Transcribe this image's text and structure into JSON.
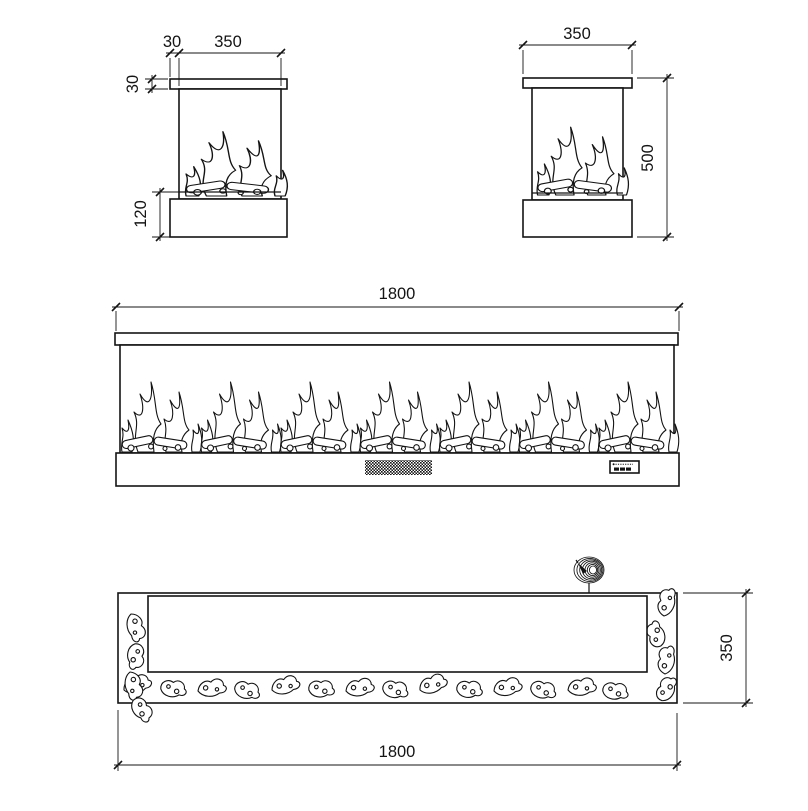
{
  "colors": {
    "line": "#141414",
    "background": "#ffffff"
  },
  "views": {
    "side_detail": {
      "dims": {
        "cap_overhang": "30",
        "width": "350",
        "cap_thickness": "30",
        "base_height": "120"
      }
    },
    "side": {
      "dims": {
        "width": "350",
        "height": "500"
      }
    },
    "front": {
      "dims": {
        "width": "1800"
      }
    },
    "plan": {
      "dims": {
        "depth": "350",
        "width": "1800"
      }
    }
  }
}
